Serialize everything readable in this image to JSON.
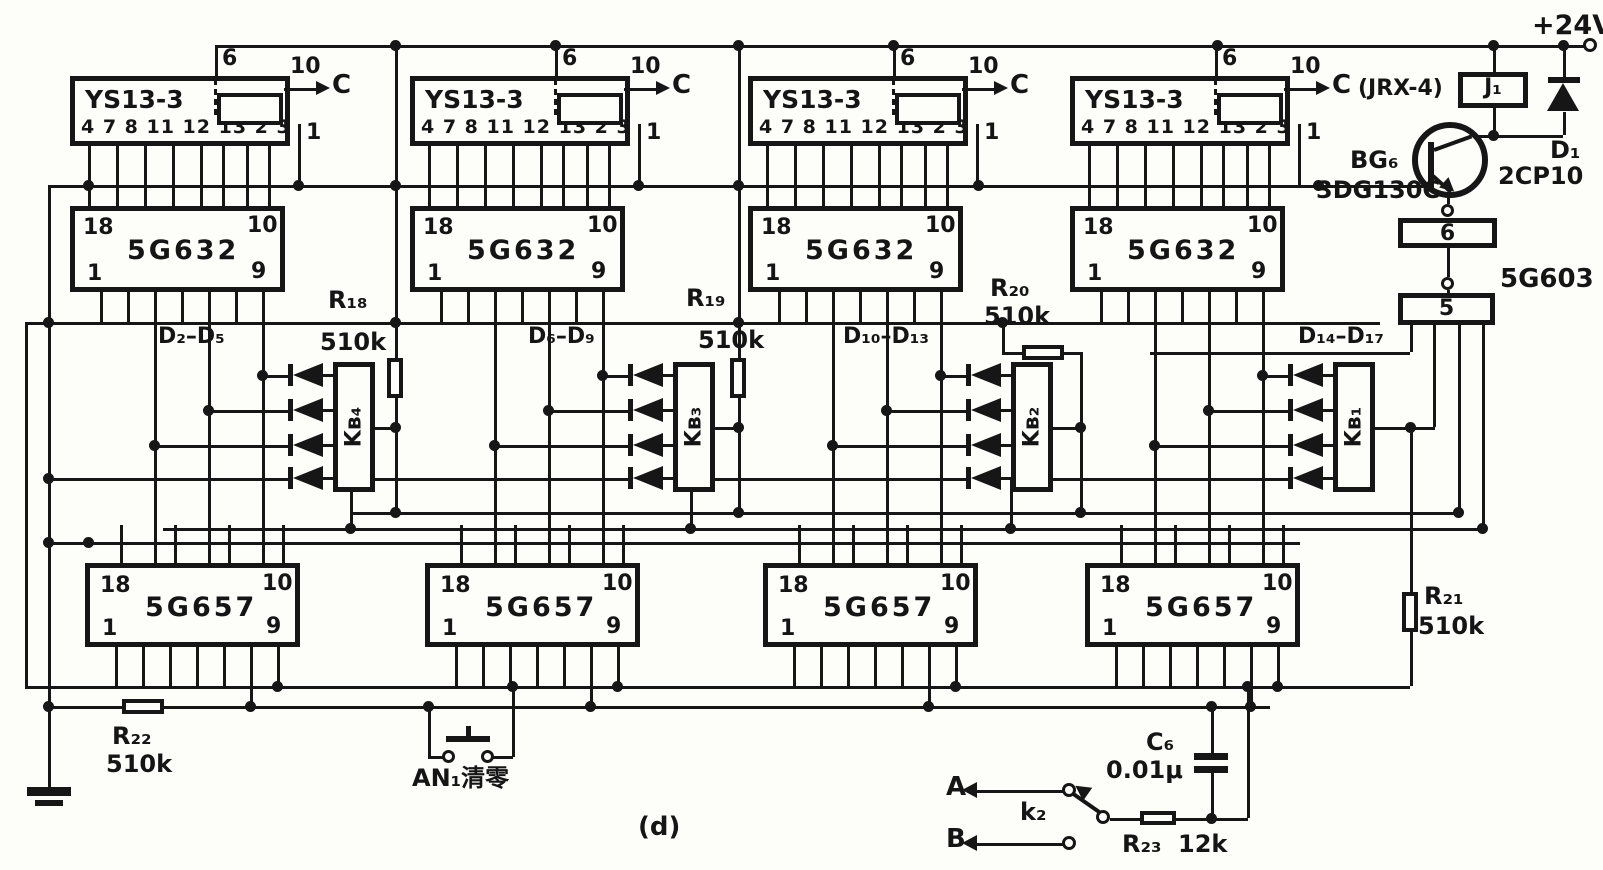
{
  "power_label": "+24V",
  "relay": {
    "note": "(JRX-4)",
    "name": "J₁"
  },
  "d1": {
    "name": "D₁",
    "type": "2CP10"
  },
  "bg6": {
    "name": "BG₆",
    "type": "3DG130C"
  },
  "ic5g603": {
    "name": "5G603",
    "pin_upper": "6",
    "pin_lower": "5"
  },
  "groups": [
    {
      "top_ic": "YS13-3",
      "pin6": "6",
      "pin10": "10",
      "pin1": "1",
      "c": "C",
      "pins": "4 7 8 11 12 13 2 3",
      "mid_ic": "5G632",
      "p18": "18",
      "p10": "10",
      "p1": "1",
      "p9": "9",
      "bot_ic": "5G657",
      "diode_range": "D₂–D₅",
      "kb": "Kʙ₄",
      "res_name": "R₁₈",
      "res_value": "510k"
    },
    {
      "top_ic": "YS13-3",
      "pin6": "6",
      "pin10": "10",
      "pin1": "1",
      "c": "C",
      "pins": "4 7 8 11 12 13 2 3",
      "mid_ic": "5G632",
      "p18": "18",
      "p10": "10",
      "p1": "1",
      "p9": "9",
      "bot_ic": "5G657",
      "diode_range": "D₆–D₉",
      "kb": "Kʙ₃",
      "res_name": "R₁₉",
      "res_value": "510k"
    },
    {
      "top_ic": "YS13-3",
      "pin6": "6",
      "pin10": "10",
      "pin1": "1",
      "c": "C",
      "pins": "4 7 8 11 12 13 2 3",
      "mid_ic": "5G632",
      "p18": "18",
      "p10": "10",
      "p1": "1",
      "p9": "9",
      "bot_ic": "5G657",
      "diode_range": "D₁₀–D₁₃",
      "kb": "Kʙ₂",
      "res_name": "R₂₀",
      "res_value": "510k"
    },
    {
      "top_ic": "YS13-3",
      "pin6": "6",
      "pin10": "10",
      "pin1": "1",
      "c": "C",
      "pins": "4 7 8 11 12 13 2 3",
      "mid_ic": "5G632",
      "p18": "18",
      "p10": "10",
      "p1": "1",
      "p9": "9",
      "bot_ic": "5G657",
      "diode_range": "D₁₄–D₁₇",
      "kb": "Kʙ₁",
      "res_name": "R₂₁",
      "res_value": "510k"
    }
  ],
  "r22": {
    "name": "R₂₂",
    "value": "510k"
  },
  "r23": {
    "name": "R₂₃",
    "value": "12k"
  },
  "c6": {
    "name": "C₆",
    "value": "0.01μ"
  },
  "clear_button": {
    "label": "AN₁清零"
  },
  "switch_k2": {
    "a": "A",
    "b": "B",
    "name": "k₂"
  },
  "caption": "(d)"
}
